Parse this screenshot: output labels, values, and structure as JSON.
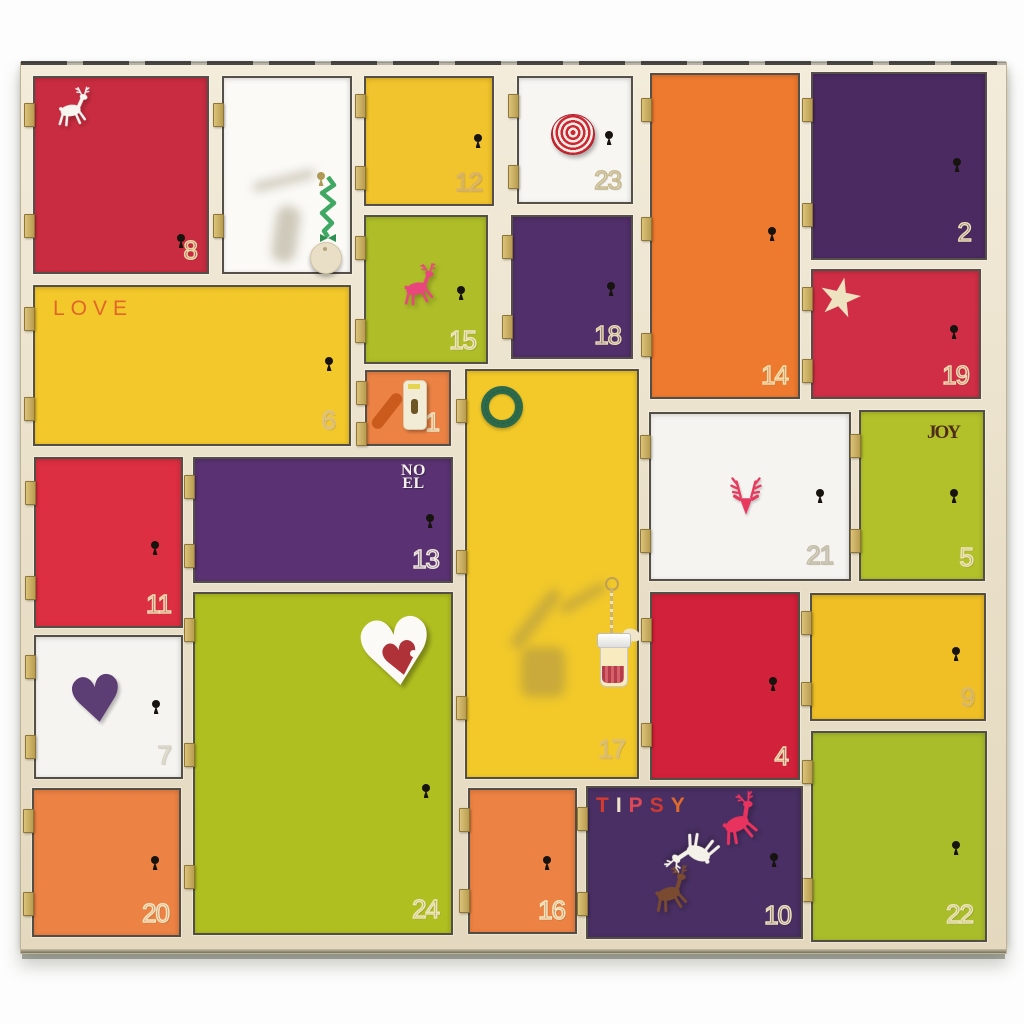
{
  "scene": "wooden advent calendar with 24 colored doors",
  "palette": {
    "background": "#fdfdfd",
    "frame_wood": "#ebe1ca",
    "frame_edge_line": "#2a2a28",
    "door_outline": "#26231e",
    "hinge_brass": "#c4a95e",
    "keyhole_black": "#17130e",
    "number_cream": "#ecdcae"
  },
  "frame": {
    "x": 20,
    "y": 62,
    "w": 985,
    "h": 890
  },
  "calendar": {
    "doors": [
      {
        "name": "door-8",
        "number": "8",
        "color": "#c92c40",
        "x": 35,
        "y": 78,
        "w": 172,
        "h": 194,
        "hinges": 2,
        "number_color": "#e9d7a4",
        "keyhole": {
          "x": 142,
          "y": 156
        },
        "decorations": [
          {
            "icon": "reindeer-icon",
            "x": 14,
            "y": 8,
            "size": 46,
            "color": "#f7f5f0",
            "rotate": -3
          }
        ]
      },
      {
        "name": "door-unnumbered",
        "number": "",
        "color": "#fbfaf7",
        "x": 224,
        "y": 78,
        "w": 126,
        "h": 194,
        "hinges": 2,
        "number_color": "#cfc6ae",
        "keyhole": {
          "x": 93,
          "y": 94,
          "color": "#b09b55"
        },
        "decorations": [
          {
            "icon": "soft-shadow",
            "x": 28,
            "y": 98,
            "w": 64,
            "h": 9,
            "rotate": -14
          },
          {
            "icon": "soft-shadow",
            "x": 50,
            "y": 128,
            "w": 24,
            "h": 56,
            "rotate": 8
          },
          {
            "icon": "ribbon-tag-icon",
            "x": 84,
            "y": 98
          }
        ]
      },
      {
        "name": "door-12",
        "number": "12",
        "color": "#f1c32c",
        "x": 366,
        "y": 78,
        "w": 126,
        "h": 126,
        "hinges": 2,
        "number_color": "#d8b264",
        "keyhole": {
          "x": 108,
          "y": 56
        }
      },
      {
        "name": "door-23",
        "number": "23",
        "color": "#f7f6f3",
        "x": 519,
        "y": 78,
        "w": 112,
        "h": 124,
        "hinges": 2,
        "number_color": "#c9ba8e",
        "keyhole": {
          "x": 86,
          "y": 53
        },
        "decorations": [
          {
            "icon": "spiral-rosette-icon",
            "x": 32,
            "y": 36,
            "size": 42
          }
        ]
      },
      {
        "name": "door-14",
        "number": "14",
        "color": "#ee7a2f",
        "x": 652,
        "y": 75,
        "w": 146,
        "h": 322,
        "hinges": 3,
        "number_color": "#f2dfae",
        "keyhole": {
          "x": 116,
          "y": 152
        }
      },
      {
        "name": "door-2",
        "number": "2",
        "color": "#4b2a62",
        "x": 813,
        "y": 74,
        "w": 172,
        "h": 184,
        "hinges": 2,
        "number_color": "#efe0b4",
        "keyhole": {
          "x": 140,
          "y": 84
        },
        "num_pos": {
          "right": 14,
          "bottom": 10
        }
      },
      {
        "name": "door-15",
        "number": "15",
        "color": "#aebd28",
        "x": 366,
        "y": 217,
        "w": 120,
        "h": 145,
        "hinges": 2,
        "number_color": "#f0e6c0",
        "keyhole": {
          "x": 91,
          "y": 69
        },
        "decorations": [
          {
            "icon": "reindeer-icon",
            "x": 28,
            "y": 46,
            "size": 48,
            "color": "#e8467d",
            "rotate": -6
          }
        ]
      },
      {
        "name": "door-18",
        "number": "18",
        "color": "#512f6a",
        "x": 513,
        "y": 217,
        "w": 118,
        "h": 140,
        "hinges": 2,
        "number_color": "#e9dab2",
        "keyhole": {
          "x": 94,
          "y": 65
        }
      },
      {
        "name": "door-19",
        "number": "19",
        "color": "#d02e46",
        "x": 813,
        "y": 271,
        "w": 166,
        "h": 126,
        "hinges": 2,
        "number_color": "#eddbb0",
        "keyhole": {
          "x": 137,
          "y": 54
        },
        "decorations": [
          {
            "icon": "star-icon",
            "x": 6,
            "y": 6,
            "size": 42,
            "color": "#efe2c0",
            "rotate": 12
          }
        ]
      },
      {
        "name": "door-6",
        "number": "6",
        "color": "#f3c82b",
        "x": 35,
        "y": 287,
        "w": 314,
        "h": 157,
        "hinges": 2,
        "number_color": "#dfc182",
        "keyhole": {
          "x": 290,
          "y": 70
        },
        "label": {
          "style": "love",
          "text": "LOVE",
          "x": 18,
          "y": 10,
          "color": "#e0662b"
        },
        "num_pos": {
          "right": 14,
          "bottom": 8
        }
      },
      {
        "name": "door-1",
        "number": "1",
        "color": "#ec8345",
        "x": 367,
        "y": 372,
        "w": 82,
        "h": 72,
        "hinges": 2,
        "number_color": "#f4e7c2",
        "decorations": [
          {
            "icon": "gift-tag-icon",
            "x": 10,
            "y": 6
          }
        ]
      },
      {
        "name": "door-17",
        "number": "17",
        "color": "#f2c929",
        "x": 467,
        "y": 371,
        "w": 170,
        "h": 406,
        "hinges": 3,
        "number_color": "#ddbe74",
        "num_pos": {
          "right": 12,
          "bottom": 12
        },
        "decorations": [
          {
            "icon": "wreath-icon",
            "x": 14,
            "y": 15,
            "size": 42
          },
          {
            "icon": "soft-shadow",
            "x": 62,
            "y": 212,
            "w": 13,
            "h": 72,
            "rotate": 38
          },
          {
            "icon": "soft-shadow",
            "x": 90,
            "y": 222,
            "w": 52,
            "h": 10,
            "rotate": -30
          },
          {
            "icon": "soft-shadow",
            "x": 54,
            "y": 276,
            "w": 44,
            "h": 50,
            "rotate": 0
          },
          {
            "icon": "jar-ornament-icon",
            "x": 130,
            "y": 206
          }
        ]
      },
      {
        "name": "door-21",
        "number": "21",
        "color": "#f5f4f1",
        "x": 651,
        "y": 414,
        "w": 198,
        "h": 165,
        "hinges": 2,
        "number_color": "#c3bca6",
        "keyhole": {
          "x": 165,
          "y": 75
        },
        "num_pos": {
          "right": 16,
          "bottom": 8
        },
        "decorations": [
          {
            "icon": "deer-head-icon",
            "x": 70,
            "y": 54,
            "size": 50,
            "color": "#e73a5e"
          }
        ]
      },
      {
        "name": "door-5",
        "number": "5",
        "color": "#b2c12a",
        "x": 861,
        "y": 412,
        "w": 122,
        "h": 167,
        "hinges": 2,
        "number_color": "#efe3ba",
        "keyhole": {
          "x": 89,
          "y": 77
        },
        "label": {
          "style": "joy",
          "text": "JOY",
          "x": 66,
          "y": 10,
          "color": "#4e2b1a"
        }
      },
      {
        "name": "door-11",
        "number": "11",
        "color": "#dc2f41",
        "x": 36,
        "y": 459,
        "w": 145,
        "h": 167,
        "hinges": 2,
        "number_color": "#eedcb2",
        "keyhole": {
          "x": 115,
          "y": 82
        }
      },
      {
        "name": "door-13",
        "number": "13",
        "color": "#5a3273",
        "x": 195,
        "y": 459,
        "w": 256,
        "h": 122,
        "hinges": 2,
        "number_color": "#eee6da",
        "keyhole": {
          "x": 231,
          "y": 55
        },
        "label": {
          "style": "noel",
          "text": "NOEL",
          "lines": [
            "NO",
            "EL"
          ],
          "x": 206,
          "y": 5,
          "color": "#f4f1ea"
        },
        "num_pos": {
          "right": 12,
          "bottom": 6
        }
      },
      {
        "name": "door-24",
        "number": "24",
        "color": "#b0bf20",
        "x": 195,
        "y": 594,
        "w": 256,
        "h": 339,
        "hinges": 3,
        "number_color": "#eee5c0",
        "keyhole": {
          "x": 227,
          "y": 190
        },
        "num_pos": {
          "right": 12,
          "bottom": 8
        },
        "decorations": [
          {
            "icon": "double-heart-icon",
            "x": 160,
            "y": 14,
            "size": 92
          }
        ]
      },
      {
        "name": "door-4",
        "number": "4",
        "color": "#d2213a",
        "x": 652,
        "y": 594,
        "w": 146,
        "h": 184,
        "hinges": 2,
        "number_color": "#f0ddb2",
        "keyhole": {
          "x": 117,
          "y": 83
        }
      },
      {
        "name": "door-9",
        "number": "9",
        "color": "#efbf25",
        "x": 812,
        "y": 595,
        "w": 172,
        "h": 124,
        "hinges": 2,
        "number_color": "#dcb967",
        "keyhole": {
          "x": 140,
          "y": 52
        }
      },
      {
        "name": "door-7",
        "number": "7",
        "color": "#f6f4f1",
        "x": 36,
        "y": 637,
        "w": 145,
        "h": 140,
        "hinges": 2,
        "number_color": "#d9d4c6",
        "keyhole": {
          "x": 116,
          "y": 63
        },
        "decorations": [
          {
            "icon": "heart-icon",
            "x": 32,
            "y": 32,
            "size": 64,
            "color": "#5d3e74",
            "rotate": -8
          }
        ]
      },
      {
        "name": "door-22",
        "number": "22",
        "color": "#a9bd2b",
        "x": 813,
        "y": 733,
        "w": 172,
        "h": 207,
        "hinges": 2,
        "number_color": "#eee4bc",
        "keyhole": {
          "x": 139,
          "y": 108
        },
        "num_pos": {
          "right": 12,
          "bottom": 10
        }
      },
      {
        "name": "door-20",
        "number": "20",
        "color": "#ec8244",
        "x": 34,
        "y": 790,
        "w": 145,
        "h": 145,
        "hinges": 2,
        "number_color": "#f4e6c0",
        "keyhole": {
          "x": 117,
          "y": 66
        }
      },
      {
        "name": "door-16",
        "number": "16",
        "color": "#ec8243",
        "x": 470,
        "y": 790,
        "w": 105,
        "h": 142,
        "hinges": 2,
        "number_color": "#f4e6c0",
        "keyhole": {
          "x": 73,
          "y": 66
        }
      },
      {
        "name": "door-10",
        "number": "10",
        "color": "#492f63",
        "x": 588,
        "y": 788,
        "w": 213,
        "h": 149,
        "hinges": 2,
        "number_color": "#efe3bc",
        "keyhole": {
          "x": 182,
          "y": 65
        },
        "label": {
          "style": "tipsy",
          "text": "TIPSY",
          "x": 8,
          "y": 6,
          "letter_colors": [
            "#d63b2e",
            "#eee3c8",
            "#dd4856",
            "#cf3a33",
            "#e06a2a"
          ]
        },
        "decorations": [
          {
            "icon": "reindeer-icon",
            "x": 122,
            "y": 6,
            "size": 56,
            "color": "#e8335f",
            "rotate": -18
          },
          {
            "icon": "reindeer-icon",
            "x": 80,
            "y": 38,
            "size": 56,
            "color": "#f4f1e8",
            "rotate": -150
          },
          {
            "icon": "reindeer-icon",
            "x": 56,
            "y": 78,
            "size": 52,
            "color": "#7a4a31",
            "rotate": -10
          }
        ]
      }
    ]
  }
}
